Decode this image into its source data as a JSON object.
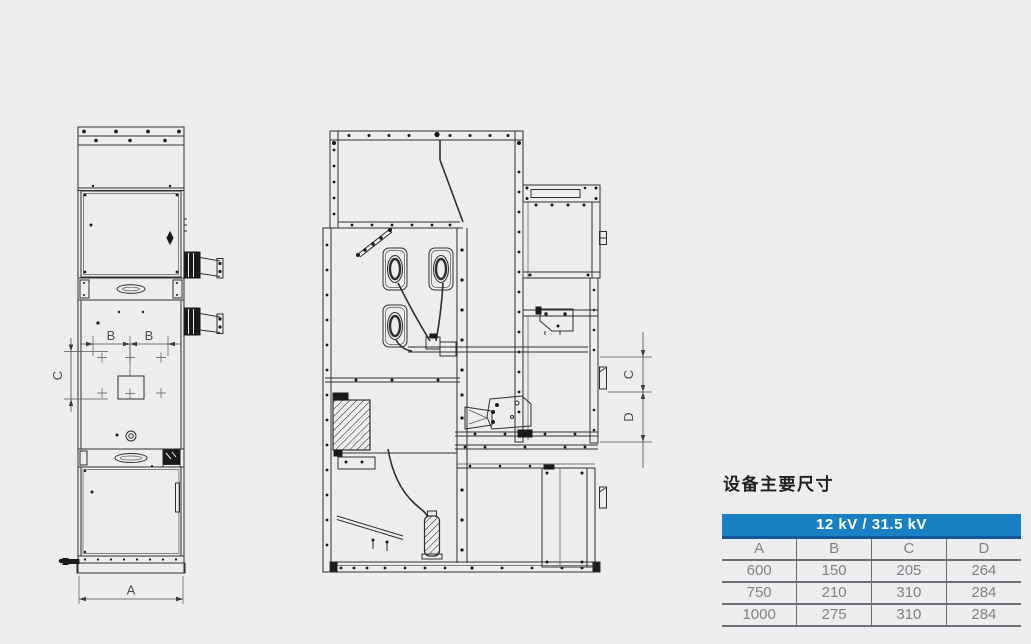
{
  "page": {
    "background_color": "#ebedee"
  },
  "drawings": {
    "front_view": {
      "description": "switchgear cabinet front elevation",
      "labels": {
        "width": "A",
        "spacing_left": "B",
        "spacing_right": "B",
        "vertical_spacing": "C"
      }
    },
    "section_view": {
      "description": "switchgear cabinet side section",
      "labels": {
        "upper": "C",
        "lower": "D"
      }
    }
  },
  "dimensions_panel": {
    "title": "设备主要尺寸",
    "table": {
      "header": "12 kV / 31.5 kV",
      "columns": [
        "A",
        "B",
        "C",
        "D"
      ],
      "rows": [
        [
          "600",
          "150",
          "205",
          "264"
        ],
        [
          "750",
          "210",
          "310",
          "284"
        ],
        [
          "1000",
          "275",
          "310",
          "284"
        ]
      ]
    },
    "colors": {
      "header_background": "#1a80c4",
      "header_underline": "#15549b",
      "table_text": "#808285",
      "rule_lines": "#6d6e71",
      "drawing_lines": "#2e2e30"
    }
  }
}
